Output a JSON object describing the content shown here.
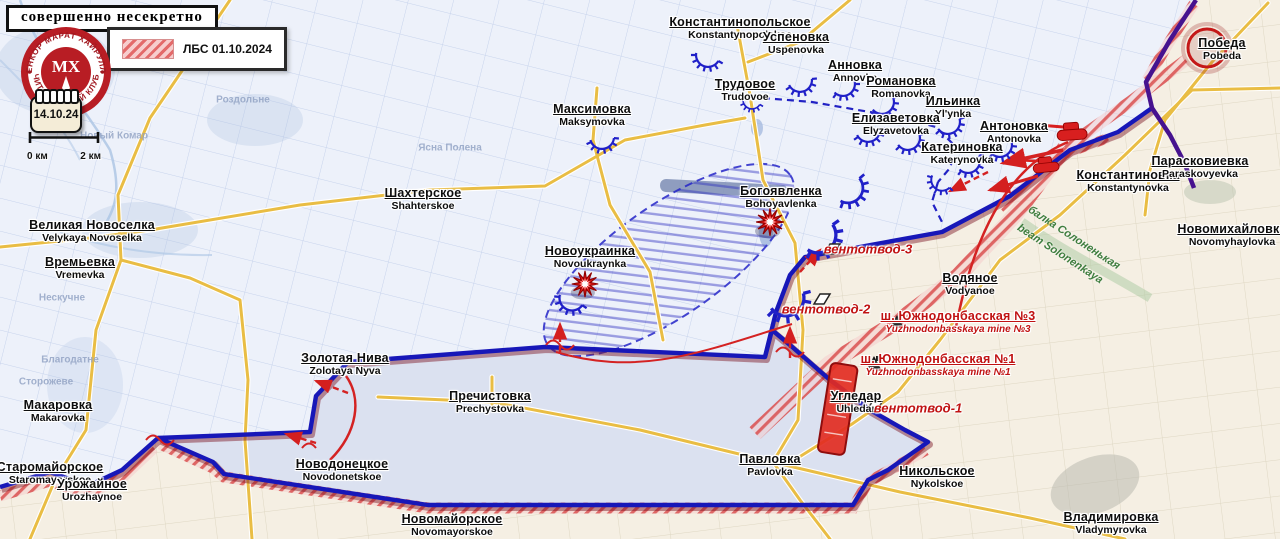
{
  "header": {
    "classification": "совершенно несекретно"
  },
  "logo": {
    "text_top": "ВОЕНКОР МАРАТ ХАЙРУЛЛИН",
    "text_bottom": "ЧИТАТЕЛЬСКИЙ КЛУБ",
    "monogram": "МХ"
  },
  "legend": {
    "label": "ЛБС 01.10.2024"
  },
  "calendar": {
    "date": "14.10.24"
  },
  "scale_bar": {
    "left_label": "0 км",
    "right_label": "2 км"
  },
  "colors": {
    "front_line_blue": "#1717b8",
    "purple_line": "#46128f",
    "lbs_hatch_red": "#d84848",
    "road_yellow": "#e9bd44",
    "annotation_red": "#c01212",
    "terrain_green": "#3e7d3e",
    "blue_zone_bg": "#edf1fa",
    "beige_zone_bg": "#f5efe3",
    "gain_strip_bg": "#dbe1f0"
  },
  "icons": [
    "explosion-icon",
    "tank-icon",
    "mine-icon",
    "vent-outlet-icon",
    "fortification-arc-icon",
    "calendar-icon",
    "scale-bar",
    "club-logo"
  ],
  "settlements": [
    {
      "name": "Константинопольское",
      "translit": "Konstantynopolskoe",
      "x": 740,
      "y": 25
    },
    {
      "name": "Успеновка",
      "translit": "Uspenovka",
      "x": 796,
      "y": 40
    },
    {
      "name": "Трудовое",
      "translit": "Trudovoe",
      "x": 745,
      "y": 87
    },
    {
      "name": "Анновка",
      "translit": "Annovka",
      "x": 855,
      "y": 68
    },
    {
      "name": "Романовка",
      "translit": "Romanovka",
      "x": 901,
      "y": 84
    },
    {
      "name": "Ильинка",
      "translit": "Yl'ynka",
      "x": 953,
      "y": 104
    },
    {
      "name": "Елизаветовка",
      "translit": "Elyzavetovka",
      "x": 896,
      "y": 121
    },
    {
      "name": "Антоновка",
      "translit": "Antonovka",
      "x": 1014,
      "y": 129
    },
    {
      "name": "Катериновка",
      "translit": "Katerynovka",
      "x": 962,
      "y": 150
    },
    {
      "name": "Константиновка",
      "translit": "Konstantynovka",
      "x": 1128,
      "y": 178
    },
    {
      "name": "Парасковиевка",
      "translit": "Paraskovyevka",
      "x": 1200,
      "y": 164
    },
    {
      "name": "Победа",
      "translit": "Pobeda",
      "x": 1222,
      "y": 46
    },
    {
      "name": "Максимовка",
      "translit": "Maksymovka",
      "x": 592,
      "y": 112
    },
    {
      "name": "Шахтерское",
      "translit": "Shahterskoe",
      "x": 423,
      "y": 196
    },
    {
      "name": "Новоукраинка",
      "translit": "Novoukraynka",
      "x": 590,
      "y": 254
    },
    {
      "name": "Богоявленка",
      "translit": "Bohoyavlenka",
      "x": 781,
      "y": 194
    },
    {
      "name": "Великая Новоселка",
      "translit": "Velykaya Novoselka",
      "x": 92,
      "y": 228
    },
    {
      "name": "Времьевка",
      "translit": "Vremevka",
      "x": 80,
      "y": 265
    },
    {
      "name": "Макаровка",
      "translit": "Makarovka",
      "x": 58,
      "y": 408
    },
    {
      "name": "Старомайорское",
      "translit": "Staromayorskoe",
      "x": 50,
      "y": 470
    },
    {
      "name": "Урожайное",
      "translit": "Urozhaynoe",
      "x": 92,
      "y": 487
    },
    {
      "name": "Новодонецкое",
      "translit": "Novodonetskoe",
      "x": 342,
      "y": 467
    },
    {
      "name": "Золотая Нива",
      "translit": "Zolotaya Nyva",
      "x": 345,
      "y": 361
    },
    {
      "name": "Пречистовка",
      "translit": "Prechystovka",
      "x": 490,
      "y": 399
    },
    {
      "name": "Новомайорское",
      "translit": "Novomayorskoe",
      "x": 452,
      "y": 522
    },
    {
      "name": "Павловка",
      "translit": "Pavlovka",
      "x": 770,
      "y": 462
    },
    {
      "name": "Никольское",
      "translit": "Nykolskoe",
      "x": 937,
      "y": 474
    },
    {
      "name": "Владимировка",
      "translit": "Vladymyrovka",
      "x": 1111,
      "y": 520
    },
    {
      "name": "Новомихайловка",
      "translit": "Novomyhaylovka",
      "x": 1232,
      "y": 232
    },
    {
      "name": "Водяное",
      "translit": "Vodyanoe",
      "x": 970,
      "y": 281
    },
    {
      "name": "Угледар",
      "translit": "Uhledar",
      "x": 856,
      "y": 399
    }
  ],
  "red_labels": [
    {
      "text": "вентотвод-3",
      "x": 868,
      "y": 249
    },
    {
      "text": "вентотвод-2",
      "x": 826,
      "y": 309
    },
    {
      "text": "вентотвод-1",
      "x": 918,
      "y": 408
    }
  ],
  "mines": [
    {
      "name": "ш. Южнодонбасская №3",
      "translit": "Yuzhnodonbasskaya mine №3",
      "x": 958,
      "y": 319
    },
    {
      "name": "ш. Южнодонбасская №1",
      "translit": "Yuzhnodonbasskaya mine №1",
      "x": 938,
      "y": 362
    }
  ],
  "terrain_labels": [
    {
      "text": "балка Солоненькая",
      "x": 1074,
      "y": 238,
      "rot": 33
    },
    {
      "text": "beam Solonenkaya",
      "x": 1060,
      "y": 254,
      "rot": 33
    }
  ],
  "base_labels": [
    {
      "text": "Новый Комар",
      "x": 114,
      "y": 136
    },
    {
      "text": "Роздольне",
      "x": 243,
      "y": 100
    },
    {
      "text": "Ясна Полена",
      "x": 450,
      "y": 148
    },
    {
      "text": "Нескучне",
      "x": 62,
      "y": 298
    },
    {
      "text": "Благодатне",
      "x": 70,
      "y": 360
    },
    {
      "text": "Сторожеве",
      "x": 46,
      "y": 382
    }
  ]
}
